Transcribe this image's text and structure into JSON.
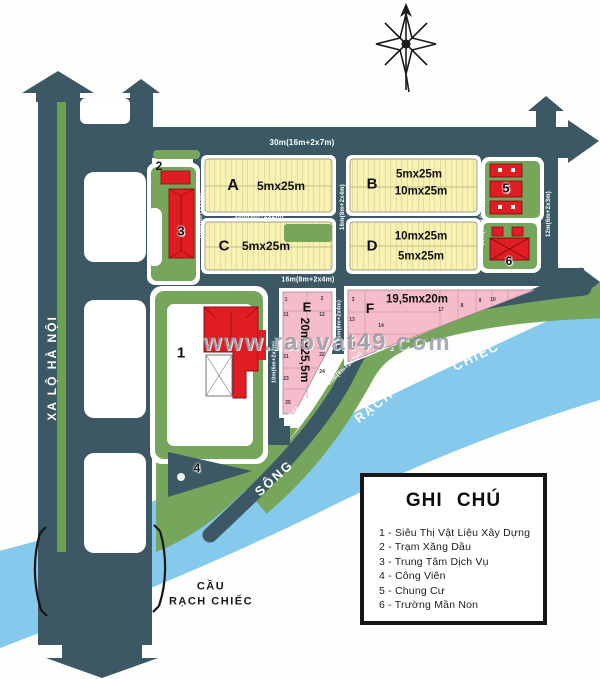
{
  "watermark": "www.raovat49.com",
  "roads": {
    "xa_lo_ha_noi": "XA LỘ HÀ NỘI",
    "top_dim": "30m(16m+2x7m)",
    "row1_dim": "10m(6m+2x2m)",
    "row2_dim": "16m(8m+2x4m)",
    "street_a_left_dim": "10m(6m+2x2m)",
    "street_ab_dim": "16m(8m+2x4m)",
    "street_b5_dim": "10m(6m+2x2m)",
    "street_56_dim": "12m(6m+2x3m)",
    "street_e_left_dim": "10m(6m+2x2m)",
    "street_ef_dim": "16m(8m+2x4m)",
    "duong_so2_name": "Đường số 2",
    "duong_so2_dim": "10m(6m+2x2m)"
  },
  "river": {
    "w1": "SÔNG",
    "w2": "RẠCH",
    "w3": "CHIẾC"
  },
  "bridge": {
    "l1": "CẦU",
    "l2": "RẠCH CHIẾC"
  },
  "blocks": {
    "a": {
      "label": "A",
      "dim": "5mx25m"
    },
    "b": {
      "label": "B",
      "dim1": "5mx25m",
      "dim2": "10mx25m"
    },
    "c": {
      "label": "C",
      "dim": "5mx25m"
    },
    "d": {
      "label": "D",
      "dim1": "10mx25m",
      "dim2": "5mx25m"
    },
    "e": {
      "label": "E",
      "dim": "20mx25,5m"
    },
    "f": {
      "label": "F",
      "dim": "19,5mx20m"
    }
  },
  "markers": {
    "m1": "1",
    "m2": "2",
    "m3": "3",
    "m4": "4",
    "m5": "5",
    "m6": "6"
  },
  "lots": {
    "e_left": [
      "1",
      "11",
      "21",
      "23",
      "25"
    ],
    "e_right": [
      "2",
      "12",
      "22",
      "24"
    ],
    "f": [
      "3",
      "13",
      "20",
      "14",
      "17",
      "8",
      "9",
      "10"
    ]
  },
  "legend": {
    "title": "GHI CHÚ",
    "items": [
      "1 - Siêu Thị Vật Liệu Xây Dựng",
      "2 - Trạm Xăng Dầu",
      "3 - Trung Tâm Dịch Vụ",
      "4 - Công Viên",
      "5 - Chung Cư",
      "6 - Trường Mần Non"
    ]
  },
  "colors": {
    "road": "#3b5864",
    "green": "#76a55c",
    "median_green": "#6aa14e",
    "yellow_block": "#f7f2b2",
    "pink_block": "#f4bdc9",
    "building_red": "#e01d23",
    "river_blue": "#85c9ec"
  }
}
